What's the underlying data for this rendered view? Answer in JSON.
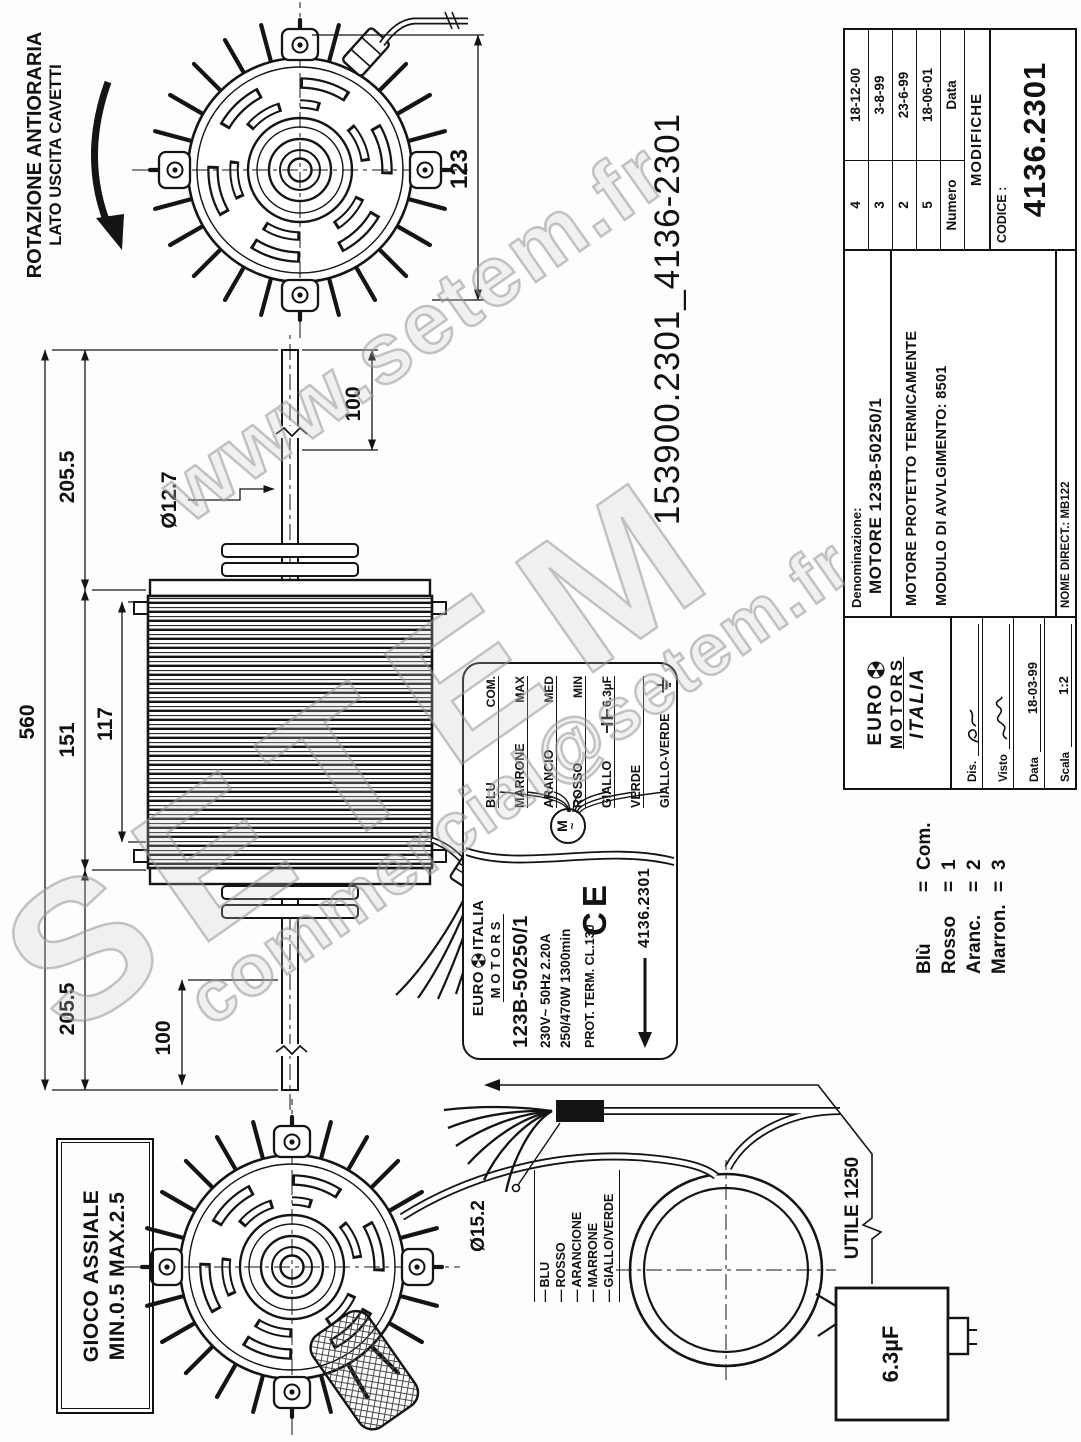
{
  "watermark": {
    "site": "www.setem.fr",
    "brand": "SETEM",
    "email": "commercial@setem.fr"
  },
  "annotations": {
    "rotation_note_line1": "ROTAZIONE ANTIORARIA",
    "rotation_note_line2": "LATO USCITA CAVETTI",
    "axial_play_line1": "GIOCO ASSIALE",
    "axial_play_line2": "MIN.0.5 MAX.2.5",
    "drawing_ref": "153900.2301_4136-2301",
    "cable_usable_length": "UTILE 1250",
    "capacitor_value": "6.3µF"
  },
  "dimensions": {
    "fan_depth": "123",
    "overall_length": "560",
    "shaft_side_a": "205.5",
    "body_length": "151",
    "fin_pack": "117",
    "shaft_side_b": "205.5",
    "shaft_end_a": "100",
    "shaft_end_b": "100",
    "shaft_diameter": "Ø12.7",
    "cable_diameter": "Ø15.2"
  },
  "nameplate": {
    "brand_top": "EURO",
    "brand_top2": "ITALIA",
    "brand_bottom": "MOTORS",
    "model": "123B-50250/1",
    "voltage": "230V~ 50Hz 2.20A",
    "power": "250/470W 1300min",
    "protection": "PROT. TERM.  CL.130",
    "code": "4136.2301",
    "ce_mark": "CE",
    "motor_symbol": "M",
    "motor_symbol_tilde": "~",
    "wiring": [
      {
        "wire": "BLU",
        "function": "COM."
      },
      {
        "wire": "MARRONE",
        "function": "MAX"
      },
      {
        "wire": "ARANCIO",
        "function": "MED"
      },
      {
        "wire": "ROSSO",
        "function": "MIN"
      },
      {
        "wire": "GIALLO",
        "function": "6.3µF"
      },
      {
        "wire": "VERDE",
        "function": ""
      },
      {
        "wire": "GIALLO-VERDE",
        "function": ""
      }
    ]
  },
  "cable_wire_labels": [
    "BLU",
    "ROSSO",
    "ARANCIONE",
    "MARRONE",
    "GIALLO/VERDE"
  ],
  "wire_legend_equals": "=",
  "wire_legend": [
    {
      "name": "Blù",
      "value": "Com."
    },
    {
      "name": "Rosso",
      "value": "1"
    },
    {
      "name": "Aranc.",
      "value": "2"
    },
    {
      "name": "Marron.",
      "value": "3"
    }
  ],
  "title_block": {
    "logo": {
      "line1": "EURO",
      "line2": "MOTORS",
      "line3": "ITALIA"
    },
    "fields": [
      {
        "label": "Dis.",
        "value": ""
      },
      {
        "label": "Visto",
        "value": ""
      },
      {
        "label": "Data",
        "value": "18-03-99"
      },
      {
        "label": "Scala",
        "value": "1:2"
      }
    ],
    "denominazione_label": "Denominazione:",
    "denominazione_value": "MOTORE  123B-50250/1",
    "desc_line1": "MOTORE  PROTETTO TERMICAMENTE",
    "desc_line2": "MODULO  DI  AVVLGIMENTO: 8501",
    "nome_direct": "NOME DIRECT.: MB122",
    "revisions": [
      {
        "numero": "4",
        "data": "18-12-00"
      },
      {
        "numero": "3",
        "data": "3-8-99"
      },
      {
        "numero": "2",
        "data": "23-6-99"
      },
      {
        "numero": "5",
        "data": "18-06-01"
      }
    ],
    "rev_header": {
      "numero": "Numero",
      "data": "Data"
    },
    "modifiche": "MODIFICHE",
    "codice_label": "CODICE :",
    "codice_value": "4136.2301"
  }
}
